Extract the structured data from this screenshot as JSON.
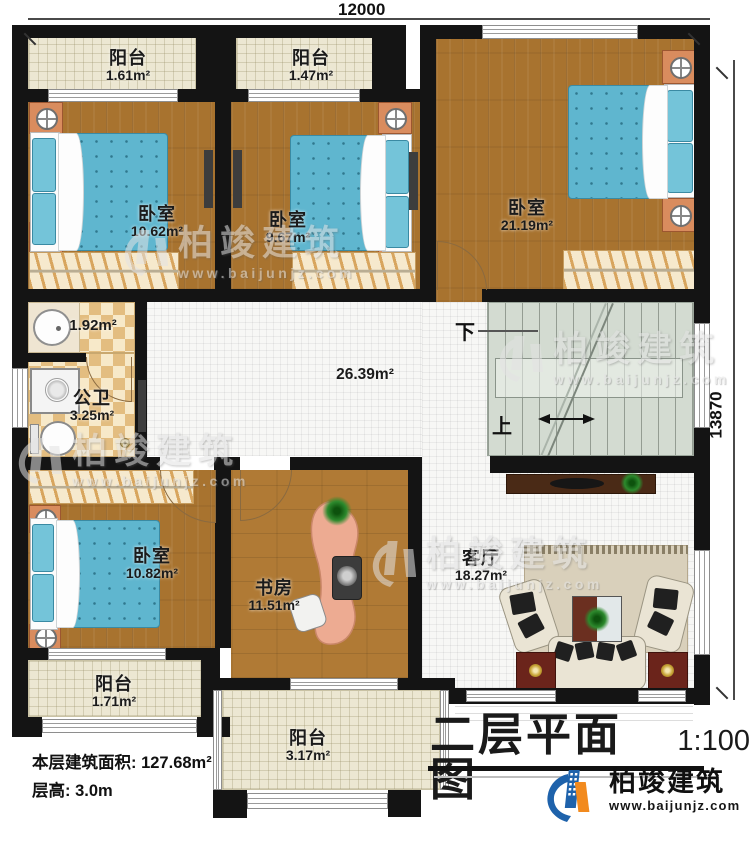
{
  "title_block": {
    "title": "二层平面图",
    "scale": "1:100"
  },
  "info": {
    "area_line": "本层建筑面积: 127.68m²",
    "height_line": "层高: 3.0m"
  },
  "dimensions": {
    "width": "12000",
    "height": "13870"
  },
  "rooms": {
    "balcony_top_left": {
      "name": "阳台",
      "area": "1.61m²"
    },
    "balcony_top_mid": {
      "name": "阳台",
      "area": "1.47m²"
    },
    "bedroom_top_left": {
      "name": "卧室",
      "area": "10.62m²"
    },
    "bedroom_top_mid": {
      "name": "卧室",
      "area": "9.67m²"
    },
    "bedroom_top_right": {
      "name": "卧室",
      "area": "21.19m²"
    },
    "vanity": {
      "area": "1.92m²"
    },
    "bathroom": {
      "name": "公卫",
      "area": "3.25m²"
    },
    "hallway": {
      "area": "26.39m²"
    },
    "bedroom_bottom_left": {
      "name": "卧室",
      "area": "10.82m²"
    },
    "study": {
      "name": "书房",
      "area": "11.51m²"
    },
    "living_room": {
      "name": "客厅",
      "area": "18.27m²"
    },
    "balcony_bottom_left": {
      "name": "阳台",
      "area": "1.71m²"
    },
    "balcony_bottom_mid": {
      "name": "阳台",
      "area": "3.17m²"
    }
  },
  "stairs": {
    "down_label": "下",
    "up_label": "上"
  },
  "watermark": {
    "brand": "柏竣建筑",
    "url": "www.baijunjz.com"
  },
  "logo": {
    "brand": "柏竣建筑",
    "url": "www.baijunjz.com"
  },
  "colors": {
    "wall": "#141414",
    "wood_floor": "#a8732f",
    "bed_blue": "#5fb6cf",
    "balcony": "#ece7d2",
    "bath_tile": "#e3bd80",
    "stair": "#d3dbd1",
    "desk_salmon": "#edab92",
    "logo_blue": "#1e62ab",
    "logo_orange": "#f28a1e"
  }
}
